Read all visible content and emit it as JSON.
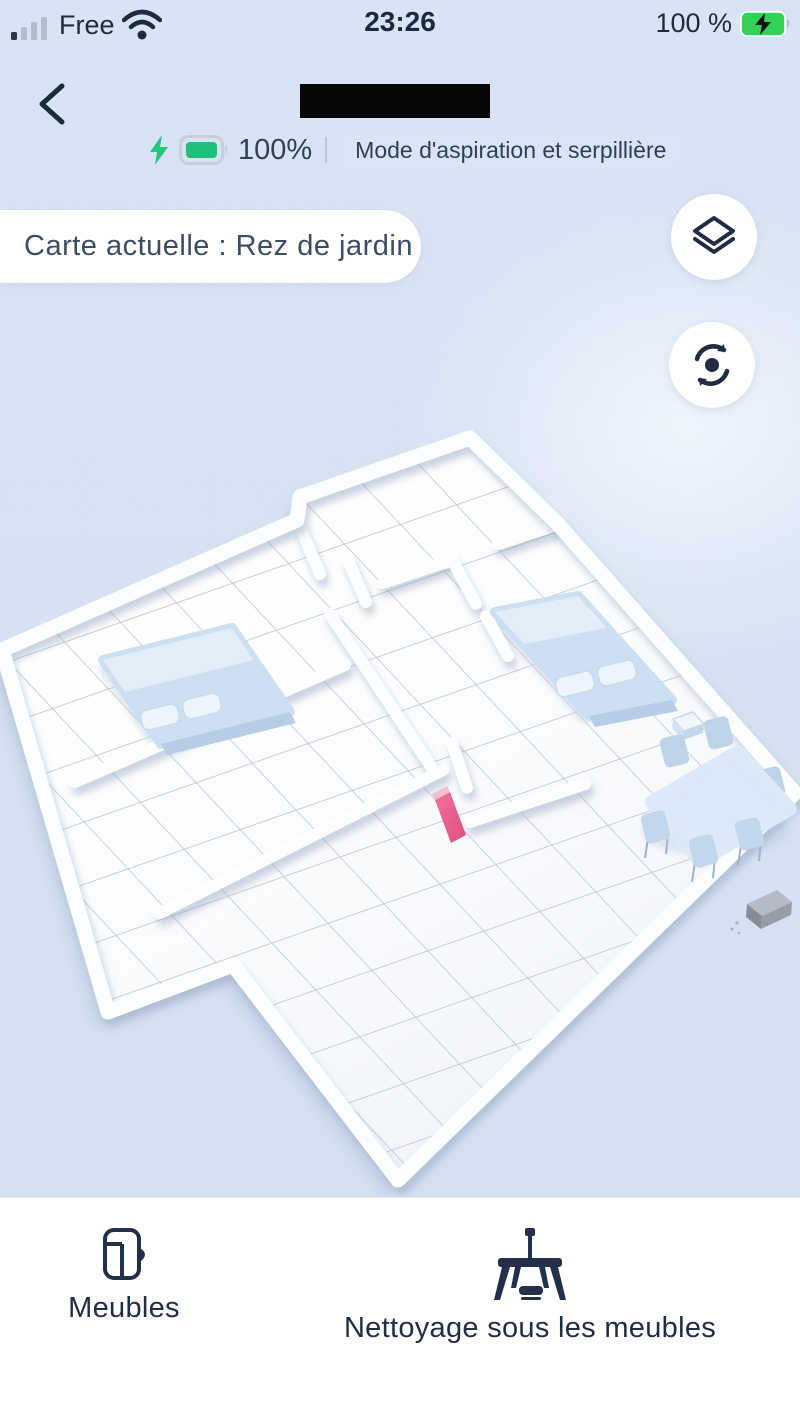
{
  "status_bar": {
    "carrier": "Free",
    "time": "23:26",
    "battery_percent": "100 %"
  },
  "header": {
    "back_icon": "chevron-left",
    "title_redacted": "",
    "battery_level": "100%",
    "mode_badge": "Mode d'aspiration et serpillière"
  },
  "map_bar": {
    "current_map_label": "Carte actuelle : Rez de jardin"
  },
  "map_controls": {
    "layers_button": "map-layers",
    "rotate_button": "reset-view"
  },
  "map_scene": {
    "type": "3d-floorplan",
    "furniture": [
      "bed-left",
      "bed-right",
      "nightstand",
      "dining-table",
      "chairs",
      "charging-dock",
      "pink-door-marker"
    ]
  },
  "bottom_nav": {
    "items": [
      {
        "label": "Meubles",
        "icon": "furniture-cabinet"
      },
      {
        "label": "Nettoyage sous les meubles",
        "icon": "table-with-robot"
      }
    ]
  },
  "colors": {
    "background": "#d7e2f3",
    "battery_green": "#1fc077",
    "badge_bg": "#dbe3f7",
    "text_navy": "#26374d",
    "floor_white": "#ffffff",
    "furniture_blue": "#cddff2",
    "pink_marker": "#e8588a",
    "dock_gray": "#8d939e"
  }
}
